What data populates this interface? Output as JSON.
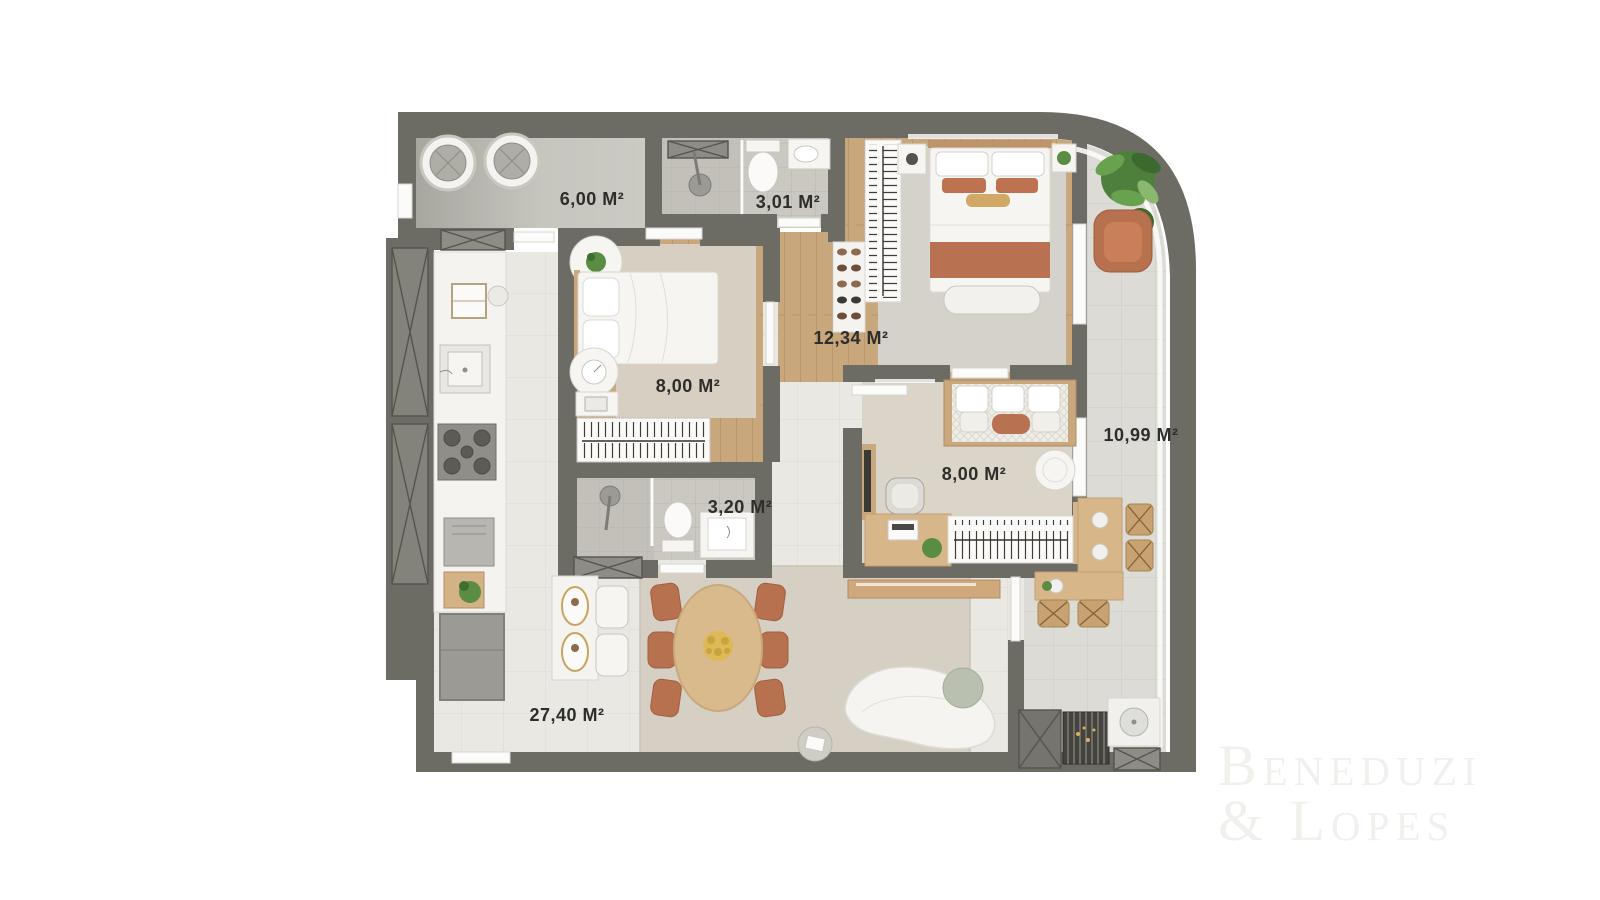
{
  "plan": {
    "rooms": [
      {
        "id": "laundry",
        "area_label": "6,00 M²"
      },
      {
        "id": "bathroom-1",
        "area_label": "3,01 M²"
      },
      {
        "id": "master-suite",
        "area_label": "12,34 M²"
      },
      {
        "id": "bedroom-1",
        "area_label": "8,00 M²"
      },
      {
        "id": "bathroom-2",
        "area_label": "3,20 M²"
      },
      {
        "id": "bedroom-2",
        "area_label": "8,00 M²"
      },
      {
        "id": "balcony",
        "area_label": "10,99 M²"
      },
      {
        "id": "living-dining",
        "area_label": "27,40 M²"
      }
    ]
  },
  "watermark": {
    "line1": "Beneduzi",
    "line2": "& Lopes"
  },
  "colors": {
    "wall": "#6c6b64",
    "wood_floor": "#c8a77c",
    "terracotta_accent": "#b8714f",
    "plant_green": "#5a8c44",
    "label_text": "#2d2d2b",
    "watermark_text": "#f0f0ed"
  }
}
